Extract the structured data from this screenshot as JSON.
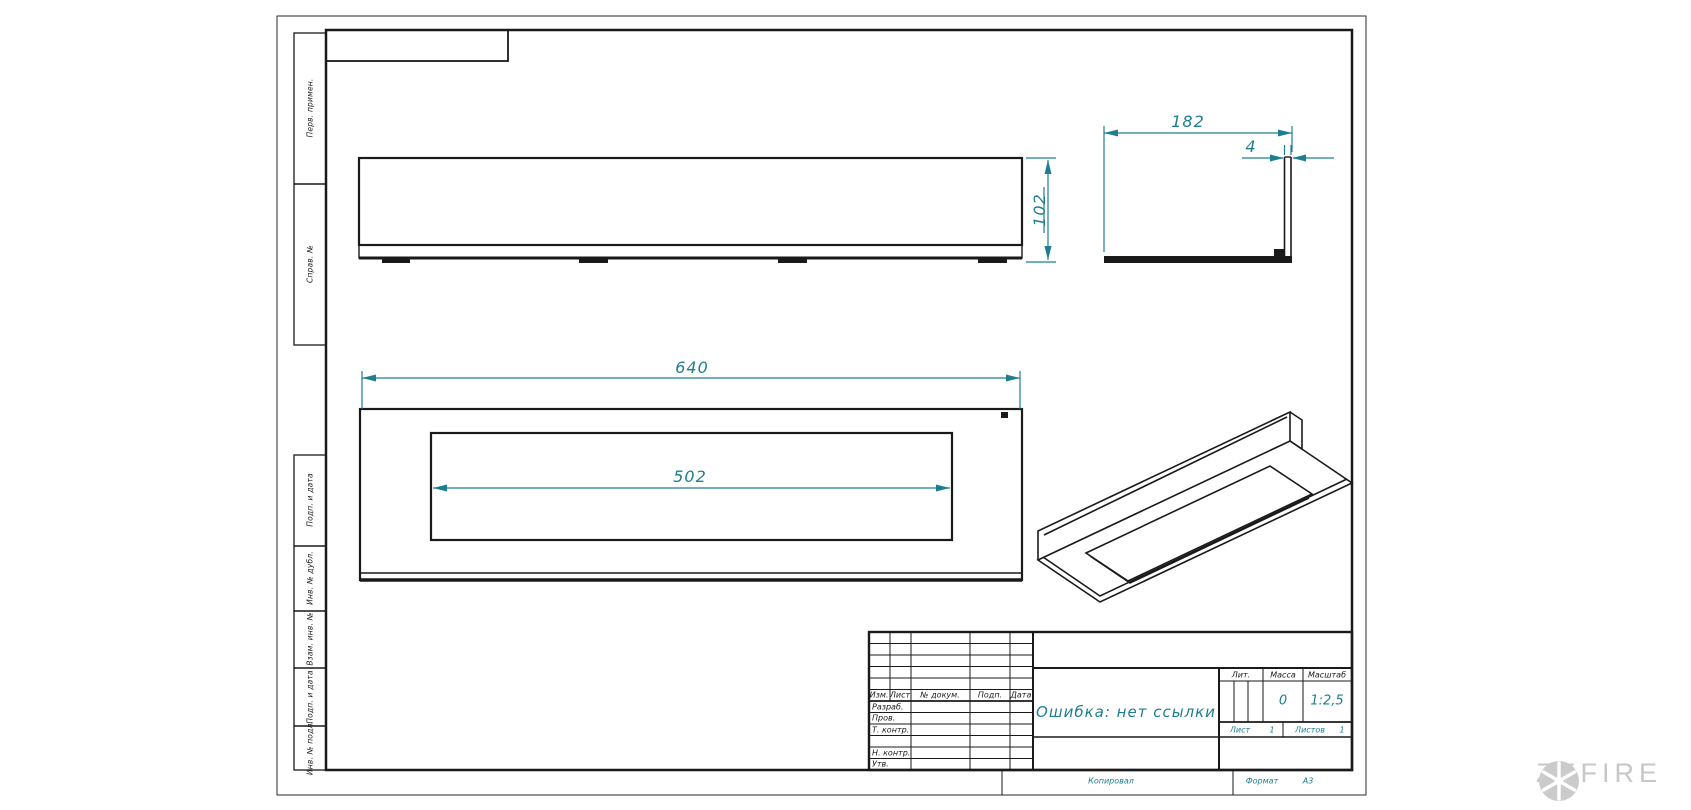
{
  "colors": {
    "accent": "#1d7f8e",
    "line": "#1a1a1a",
    "watermark": "#c7c7c7"
  },
  "margin_labels": [
    "Перв. примен.",
    "Справ. №",
    "Подп. и дата",
    "Инв. № дубл.",
    "Взам. инв. №",
    "Подп. и дата",
    "Инв. № подл."
  ],
  "dimensions": {
    "length": "640",
    "opening_length": "502",
    "depth": "182",
    "wall_thickness": "4",
    "height": "102"
  },
  "title_block": {
    "revision_header": [
      "Изм.",
      "Лист",
      "№ докум.",
      "Подп.",
      "Дата"
    ],
    "staff_rows": [
      "Разраб.",
      "Пров.",
      "Т. контр.",
      "Н. контр.",
      "Утв."
    ],
    "document_title": "Ошибка: нет ссылки",
    "literature_label": "Лит.",
    "mass_label": "Масса",
    "scale_label": "Масштаб",
    "mass_value": "0",
    "scale_value": "1:2,5",
    "sheet_label": "Лист",
    "sheet_value": "1",
    "sheets_label": "Листов",
    "sheets_value": "1"
  },
  "footer": {
    "copied_by": "Копировал",
    "format_label": "Формат",
    "format_value": "А3"
  },
  "watermark": {
    "brand": "ZEFIRE"
  }
}
